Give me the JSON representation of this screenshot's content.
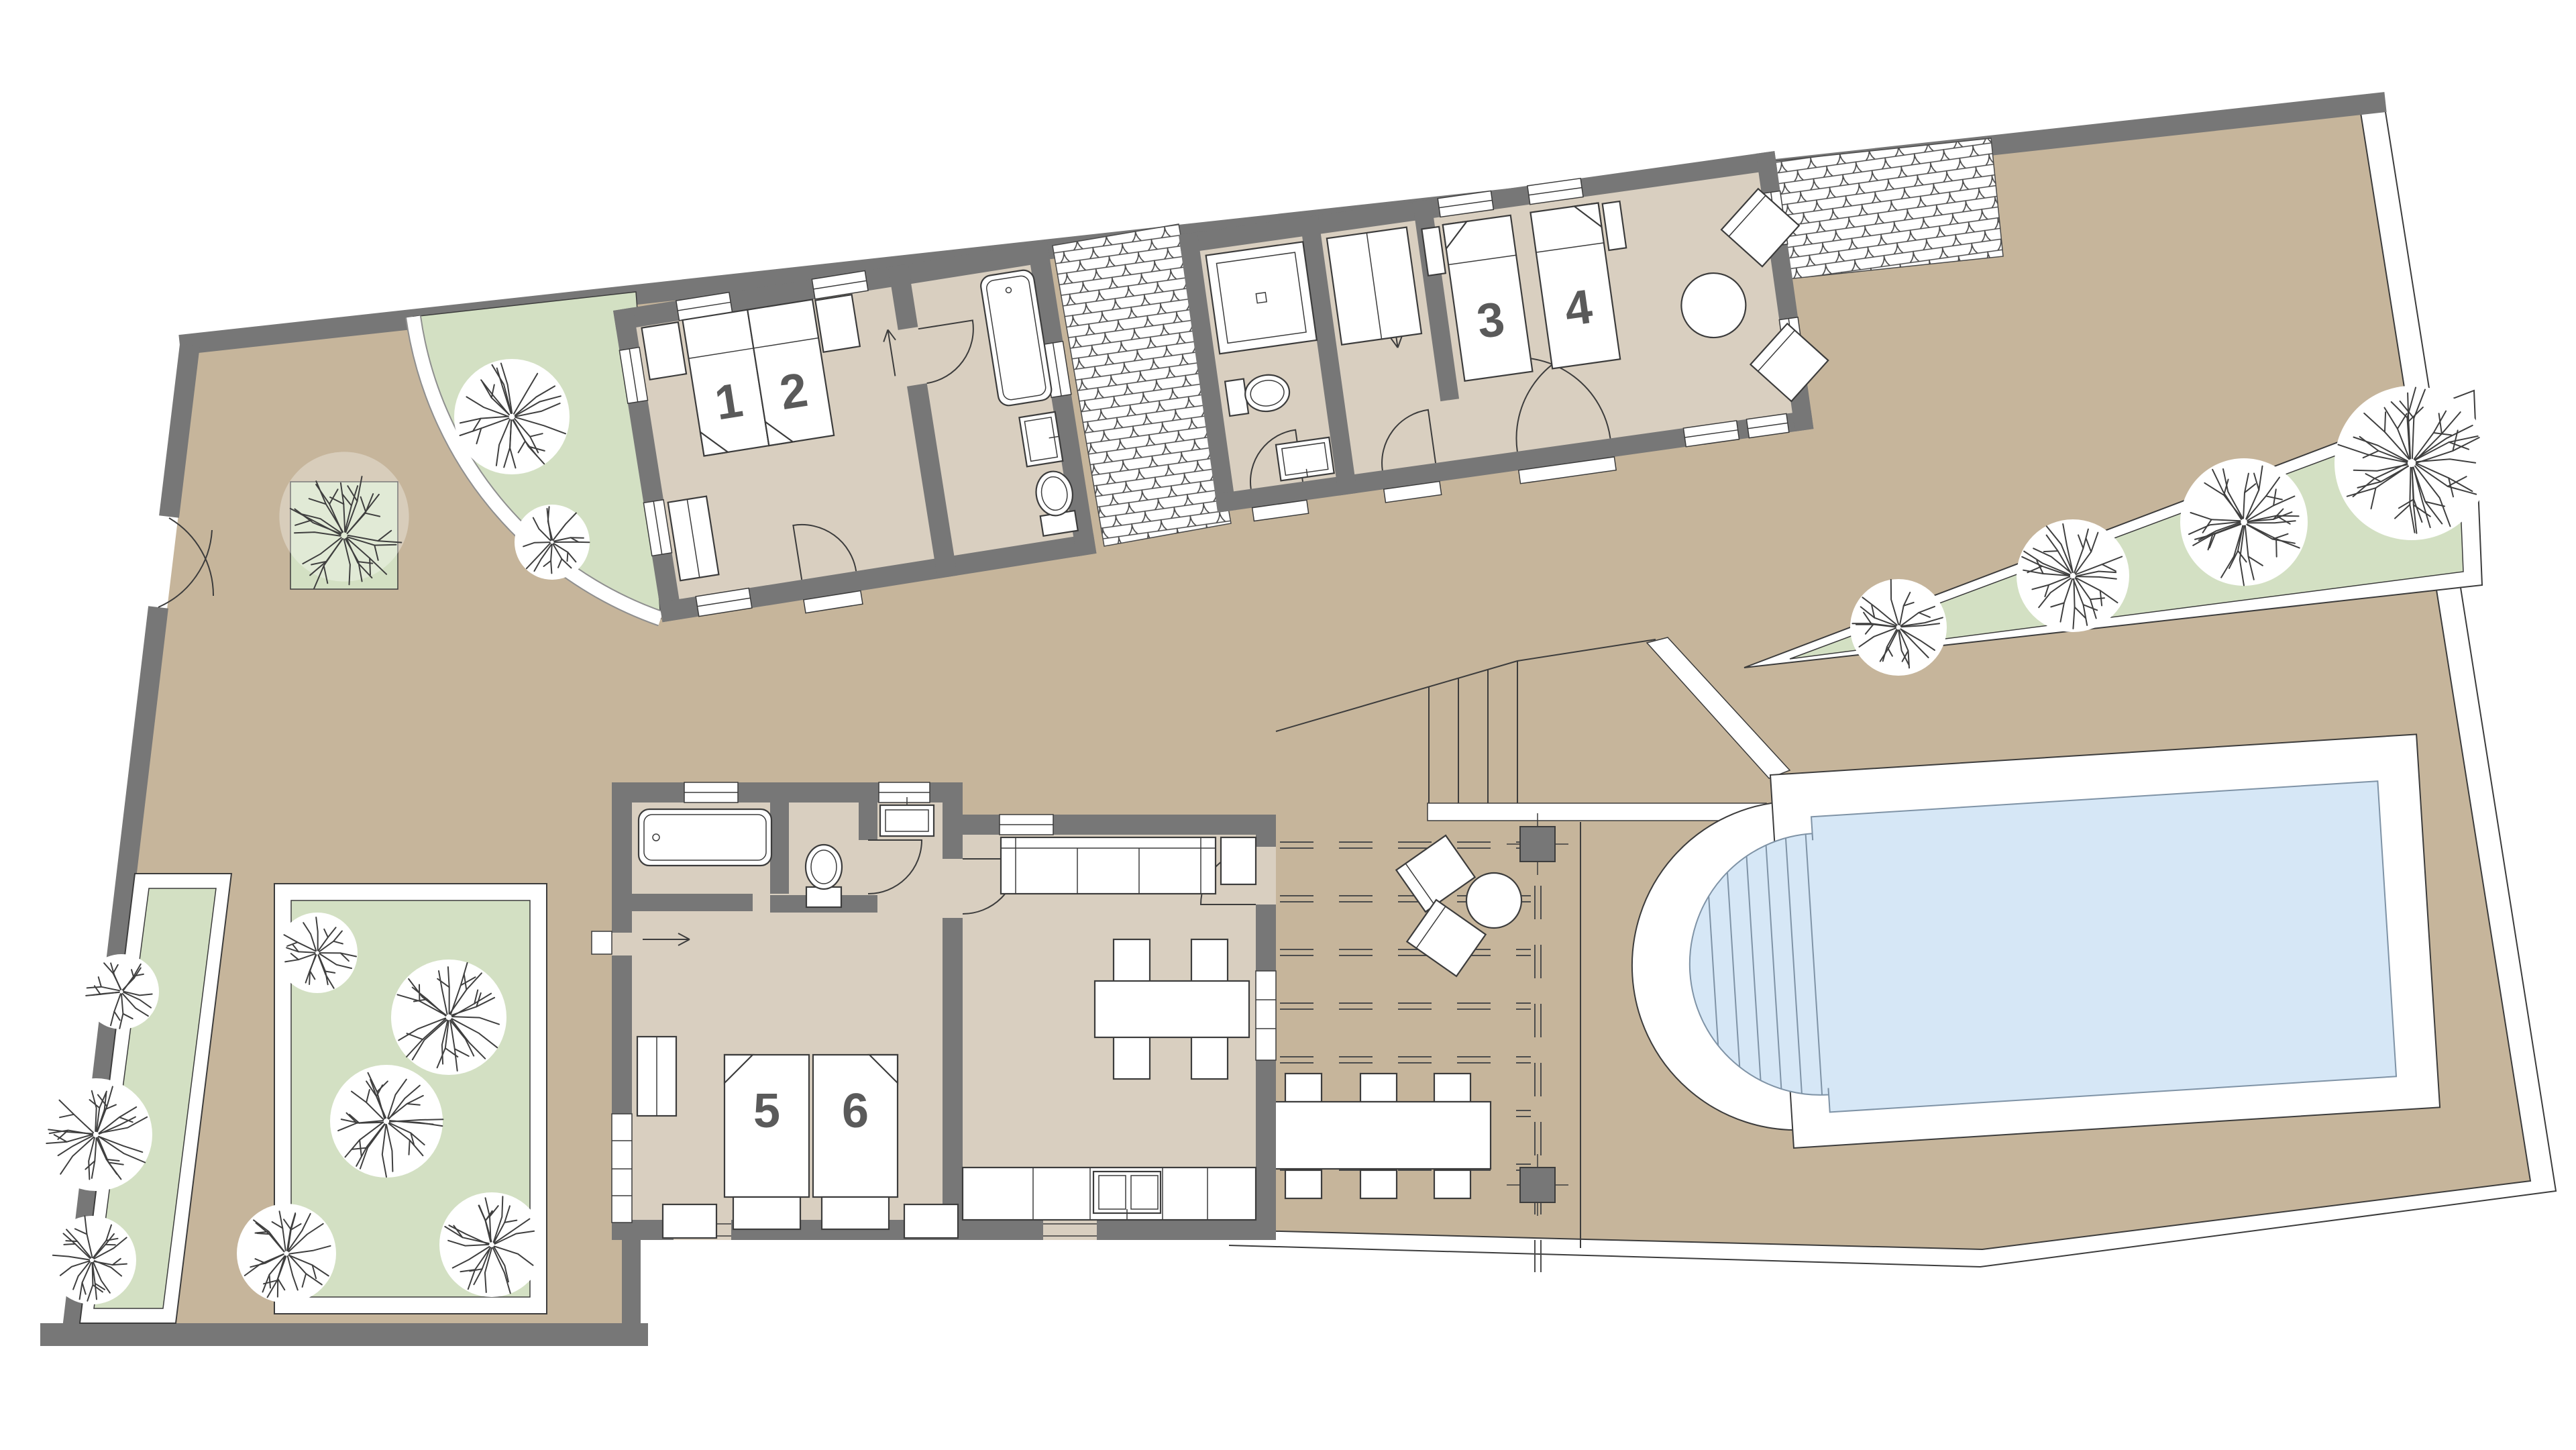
{
  "palette": {
    "wall": "#777777",
    "wall_outline": "#3d3d3d",
    "floor": "#d9cfc0",
    "courtyard": "#c6b59b",
    "garden": "#d3e0c3",
    "garden_border": "#ffffff",
    "water": "#d6e7f6",
    "water_line": "#7f93a6",
    "line": "#3c3c3c",
    "furniture_fill": "#ffffff",
    "label": "#5a5a5a"
  },
  "beds": [
    {
      "label": "1"
    },
    {
      "label": "2"
    },
    {
      "label": "3"
    },
    {
      "label": "4"
    },
    {
      "label": "5"
    },
    {
      "label": "6"
    }
  ],
  "icons": {
    "bed": "bed-icon",
    "bathtub": "bathtub-icon",
    "shower": "shower-icon",
    "toilet": "toilet-icon",
    "sink": "sink-icon",
    "sofa": "sofa-icon",
    "dining_table": "dining-table-icon",
    "chair": "chair-icon",
    "lounge_chair": "lounge-chair-icon",
    "round_table": "round-table-icon",
    "tree": "tree-icon",
    "pool": "pool-icon",
    "pool_steps": "pool-steps-icon",
    "pergola_post": "pergola-post-icon",
    "door_swing": "door-swing-icon",
    "gate": "gate-icon",
    "direction_arrow": "direction-arrow-icon",
    "cobblestone": "cobblestone-paving-icon",
    "wardrobe": "wardrobe-icon",
    "kitchen_sink": "kitchen-sink-icon"
  }
}
